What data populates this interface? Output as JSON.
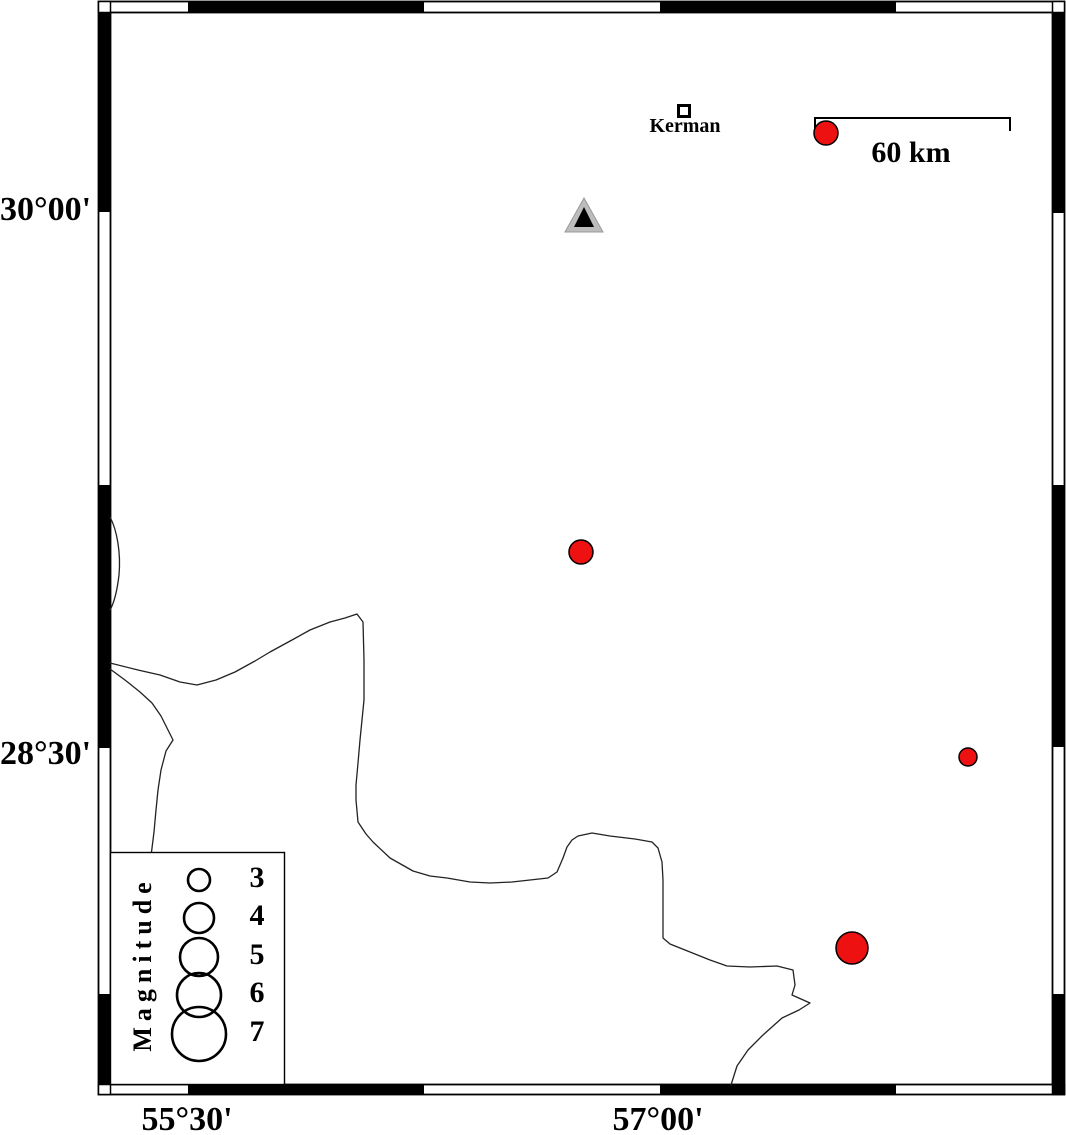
{
  "axis": {
    "left": [
      {
        "text": "30°00'",
        "y": 209
      },
      {
        "text": "28°30'",
        "y": 753
      }
    ],
    "bottom": [
      {
        "text": "55°30'",
        "x": 188
      },
      {
        "text": "57°00'",
        "x": 658
      }
    ]
  },
  "city": {
    "label": "Kerman",
    "x": 684,
    "y": 111
  },
  "scale_bar": {
    "label": "60 km",
    "x_start": 815,
    "x_end": 1010,
    "y": 118,
    "tick_drop": 13
  },
  "station": {
    "x": 584,
    "y": 218,
    "outer_color": "#bdbdbd",
    "inner_color": "#000000"
  },
  "earthquakes": {
    "fill_color": "#ee1111",
    "points": [
      {
        "x": 826,
        "y": 133,
        "r": 12
      },
      {
        "x": 581,
        "y": 552,
        "r": 12
      },
      {
        "x": 968,
        "y": 757,
        "r": 9
      },
      {
        "x": 852,
        "y": 948,
        "r": 16
      }
    ]
  },
  "legend": {
    "title": "Magnitude",
    "circle_cx": 199,
    "label_cx": 257,
    "entries": [
      {
        "label": "3",
        "r": 11,
        "cy": 880
      },
      {
        "label": "4",
        "r": 15,
        "cy": 918
      },
      {
        "label": "5",
        "r": 19,
        "cy": 957
      },
      {
        "label": "6",
        "r": 22,
        "cy": 995
      },
      {
        "label": "7",
        "r": 27,
        "cy": 1034
      }
    ]
  }
}
